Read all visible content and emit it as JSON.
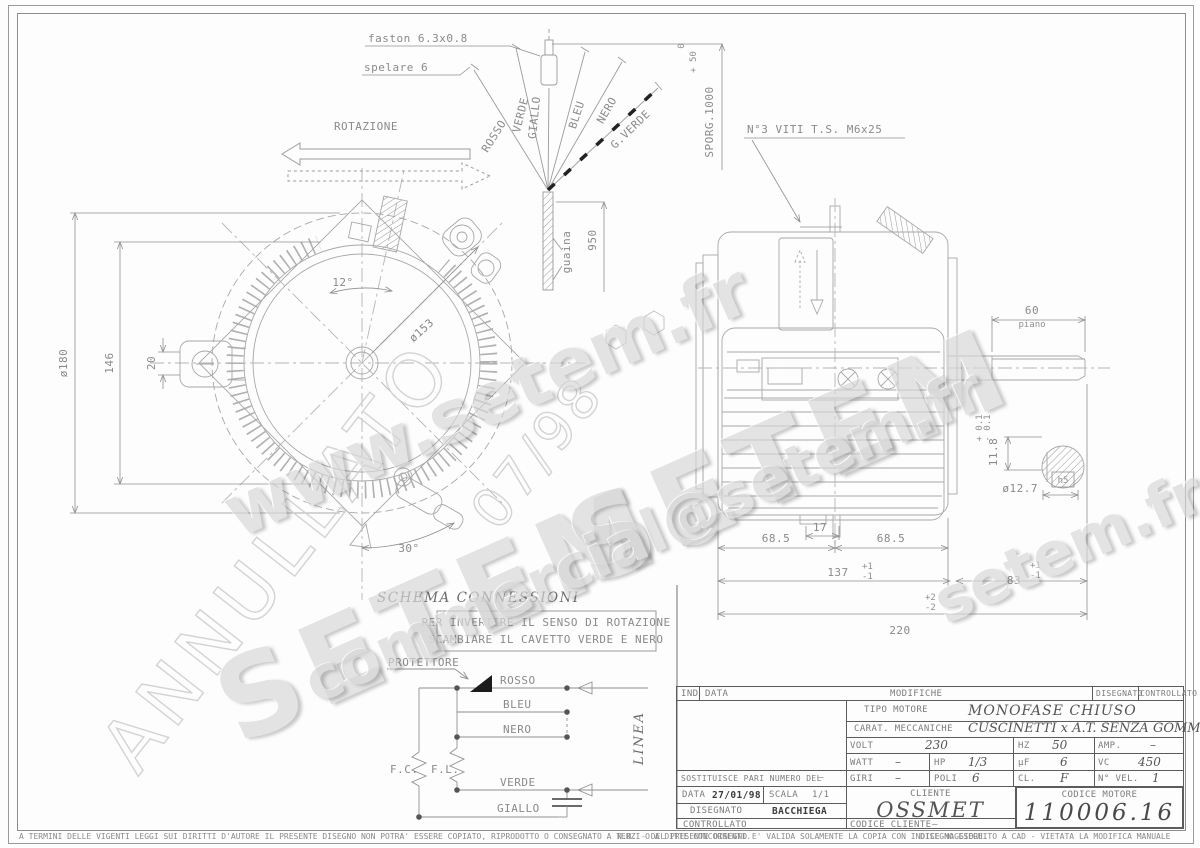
{
  "watermarks": {
    "www": "www.setem.fr",
    "setem": "SETEM",
    "commercial": "commercial@setem.fr",
    "setemfr": "setem.fr",
    "annullato": "ANNULLATO",
    "stamp": "07/98"
  },
  "top": {
    "faston": "faston 6.3x0.8",
    "spelare": "spelare 6",
    "rotazione": "ROTAZIONE",
    "viti": "N°3 VITI T.S. M6x25",
    "sporg": "SPORG.1000",
    "sporg_plus": "+ 50",
    "sporg_minus": "0",
    "guaina": "guaina",
    "dim950": "950",
    "wires": [
      "ROSSO",
      "VERDE",
      "GIALLO",
      "BLEU",
      "NERO",
      "G.VERDE"
    ]
  },
  "front_view": {
    "dia180": "ø180",
    "dim146": "146",
    "dim20": "20",
    "dia153": "ø153",
    "angle12": "12°",
    "angle30": "30°"
  },
  "side_view": {
    "dim60": "60",
    "piano": "piano",
    "dim118": "11.8",
    "tol118_p": "+ 0.1",
    "tol118_m": "- 0.1",
    "dia127": "ø12.7",
    "h5": "h5",
    "dim17": "17",
    "dim685a": "68.5",
    "dim685b": "68.5",
    "dim137": "137",
    "tol137_p": "+1",
    "tol137_m": "-1",
    "dim83": "83",
    "tol83_p": "+1",
    "tol83_m": "-1",
    "dim220": "220",
    "tol220_p": "+2",
    "tol220_m": "-2"
  },
  "schema": {
    "title": "SCHEMA CONNESSIONI",
    "note1": "PER INVERTIRE IL SENSO DI ROTAZIONE",
    "note2": "SCAMBIARE IL CAVETTO VERDE E NERO",
    "protettore": "PROTETTORE",
    "wires": [
      "ROSSO",
      "BLEU",
      "NERO",
      "VERDE",
      "GIALLO"
    ],
    "fc": "F.C.",
    "fl": "F.L.",
    "linea": "LINEA"
  },
  "title_block": {
    "ind": "IND",
    "data_h": "DATA",
    "modifiche": "MODIFICHE",
    "disegnato_h": "DISEGNATO",
    "controllato_h": "CONTROLLATO",
    "tipo_label": "TIPO MOTORE",
    "tipo": "MONOFASE CHIUSO",
    "carat_label": "CARAT. MECCANICHE",
    "carat": "CUSCINETTI x A.T. SENZA GOMME",
    "volt_label": "VOLT",
    "volt": "230",
    "hz_label": "HZ",
    "hz": "50",
    "amp_label": "AMP.",
    "amp": "–",
    "watt_label": "WATT",
    "watt": "–",
    "hp_label": "HP",
    "hp": "1/3",
    "uf_label": "μF",
    "uf": "6",
    "vc_label": "VC",
    "vc": "450",
    "giri_label": "GIRI",
    "giri": "–",
    "poli_label": "POLI",
    "poli": "6",
    "cl_label": "CL.",
    "cl": "F",
    "nvel_label": "N° VEL.",
    "nvel": "1",
    "sostituisce": "SOSTITUISCE PARI NUMERO DEL",
    "sostituisce_val": "–",
    "data_label": "DATA",
    "data_val": "27/01/98",
    "scala_label": "SCALA",
    "scala_val": "1/1",
    "disegnato_label": "DISEGNATO",
    "disegnato_val": "BACCHIEGA",
    "controllato_label": "CONTROLLATO",
    "cliente_label": "CLIENTE",
    "cliente": "OSSMET",
    "codice_cliente_label": "CODICE CLIENTE",
    "codice_cliente": "–",
    "codice_motore_label": "CODICE MOTORE",
    "codice_motore": "110006.16"
  },
  "footer": {
    "left": "A TERMINI DELLE VIGENTI LEGGI SUI DIRITTI D'AUTORE IL PRESENTE DISEGNO NON POTRA' ESSERE COPIATO, RIPRODOTTO O CONSEGNATO A TERZI O A DITTE CONCORRENTI.",
    "nb": "N.B. - DEL PRESENTE DISEGNO E' VALIDA SOLAMENTE LA COPIA CON INDICE MAGGIORE.",
    "cad": "DISEGNO ESEGUITO A CAD - VIETATA LA MODIFICA MANUALE"
  }
}
